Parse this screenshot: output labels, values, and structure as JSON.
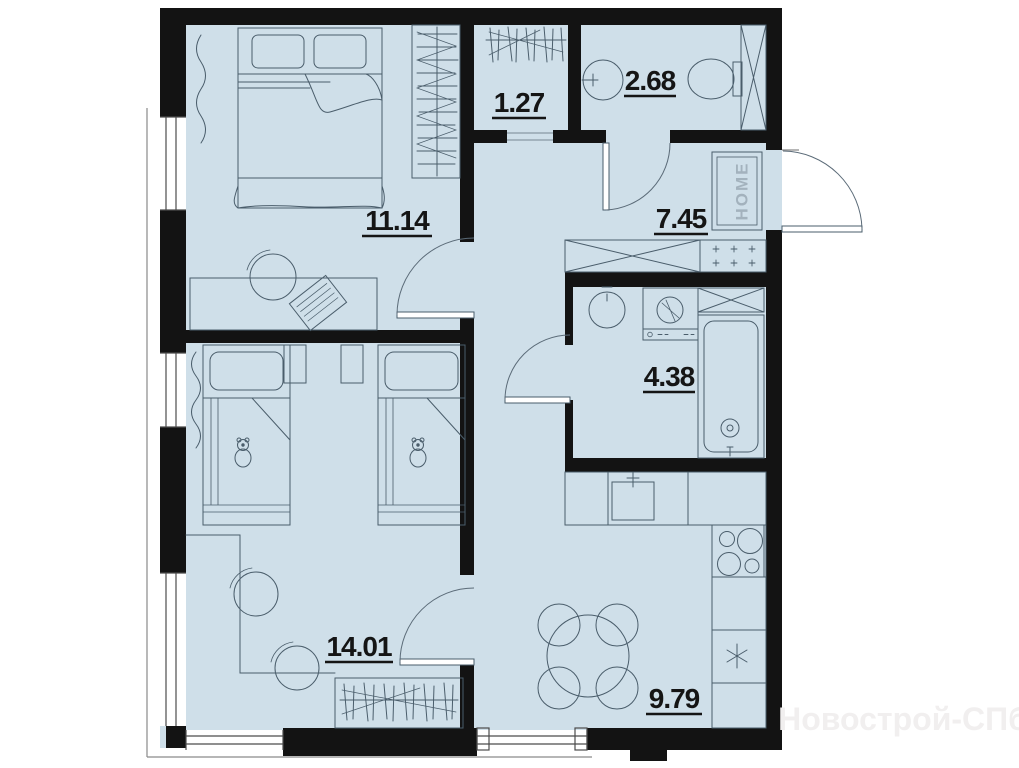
{
  "rooms": {
    "bedroom": "11.14",
    "closet": "1.27",
    "bathroom_top": "2.68",
    "hallway": "7.45",
    "bathroom_main": "4.38",
    "kids_room": "14.01",
    "kitchen_living": "9.79"
  },
  "doormat": "HOME",
  "watermark": "Новострой-СПб",
  "colors": {
    "floor": "#cfdfe9",
    "wall": "#131313",
    "furniture_line": "#4a5d6b"
  }
}
